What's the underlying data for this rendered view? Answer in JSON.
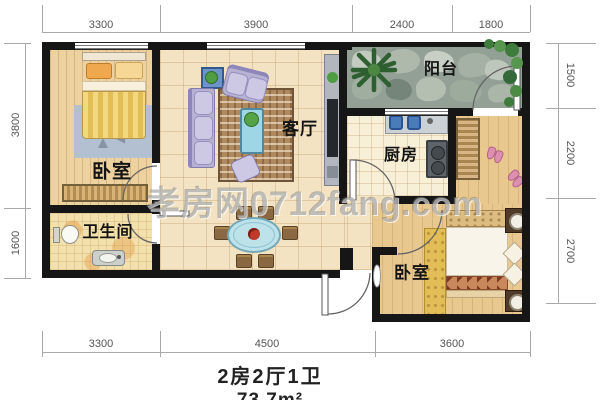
{
  "plan": {
    "watermark": "孝房网0712fang.com",
    "caption": {
      "layout": "2房2厅1卫",
      "area": "73.7m²"
    },
    "rooms": {
      "bedroom1": "卧室",
      "living": "客厅",
      "balcony": "阳台",
      "kitchen": "厨房",
      "bathroom": "卫生间",
      "bedroom2": "卧室"
    },
    "dims": {
      "top": [
        "3300",
        "3900",
        "2400",
        "1800"
      ],
      "bottom": [
        "3300",
        "4500",
        "3600"
      ],
      "left": [
        "3800",
        "1600"
      ],
      "right": [
        "1500",
        "2200",
        "2700"
      ]
    },
    "colors": {
      "wall": "#161616",
      "tile": "#f3e3c3",
      "wood_light": "#edd2a0",
      "wood_warm": "#e9c88f",
      "balcony_stone": "#93a096",
      "sofa": "#b7b1d4",
      "accent_blue": "#5d87c2",
      "rug_brown": "#b08a5e",
      "dim_line": "#a9a9a9"
    }
  }
}
